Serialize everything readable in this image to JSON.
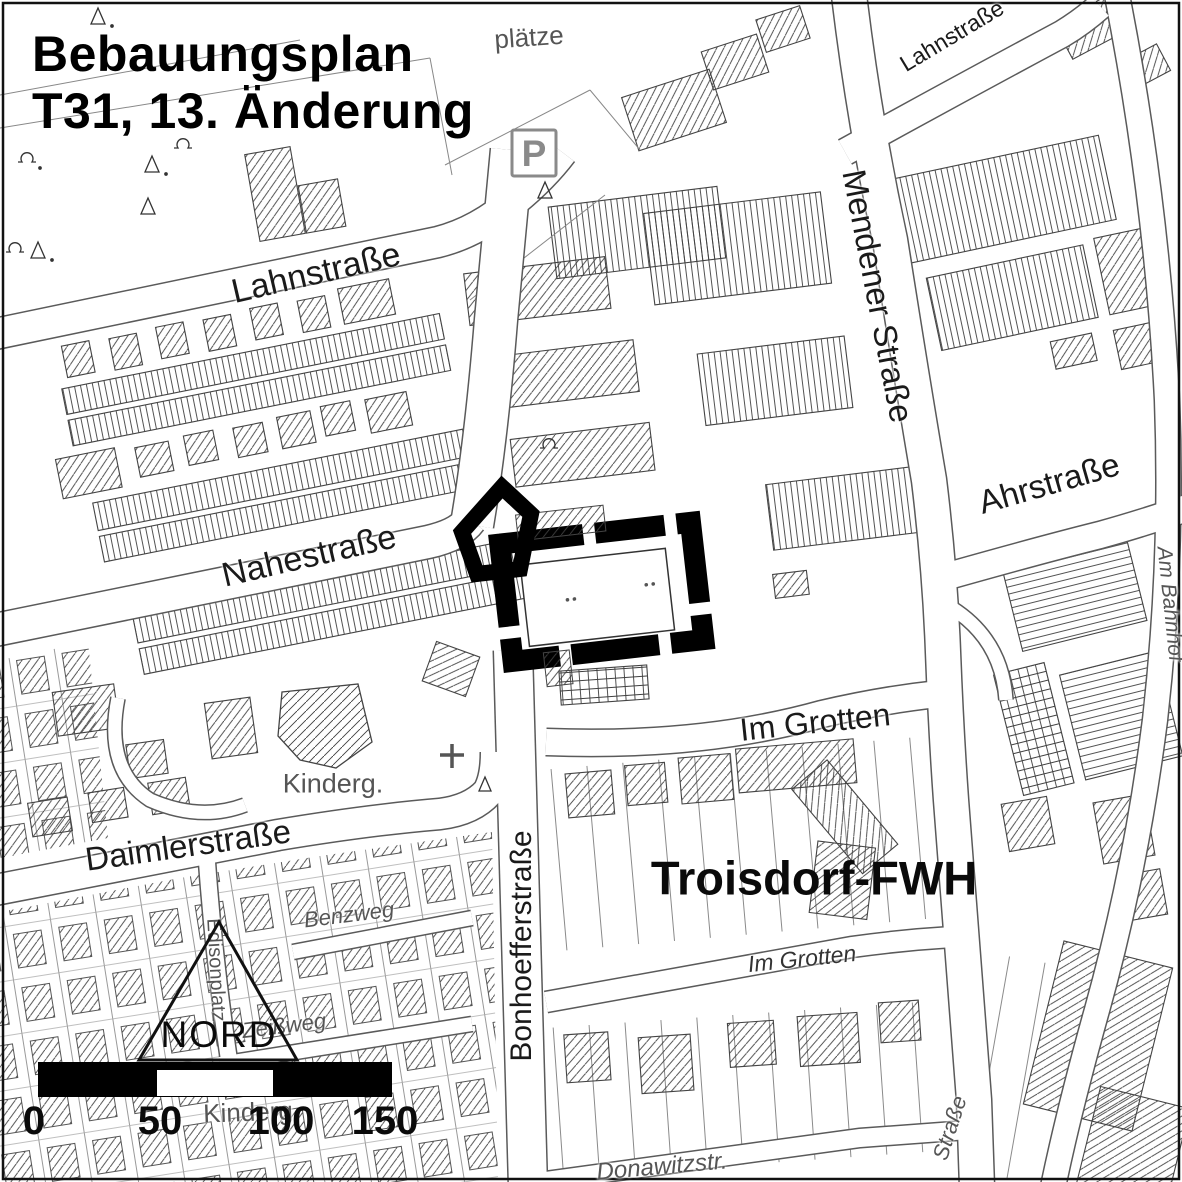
{
  "map": {
    "title": {
      "line1": "Bebauungsplan",
      "line2": "T31, 13. Änderung"
    },
    "region_label": "Troisdorf-FWH",
    "parking_symbol": "P",
    "north_label": "NORD",
    "scale_bar": {
      "ticks": [
        "0",
        "50",
        "100",
        "150"
      ]
    },
    "colors": {
      "ink": "#1a1a1a",
      "muted": "#555555",
      "hatch": "#3f3f3f",
      "street_edge": "#5a5a5a",
      "plan_boundary": "#000000"
    },
    "labels": [
      {
        "name": "street-label-lahnstrasse-top",
        "text": "Lahnstraße",
        "x": 952,
        "y": 36,
        "rot": -31,
        "size": 23,
        "cls": ""
      },
      {
        "name": "street-label-lahnstrasse",
        "text": "Lahnstraße",
        "x": 316,
        "y": 273,
        "rot": -13,
        "size": 34,
        "cls": ""
      },
      {
        "name": "street-label-nahestrasse",
        "text": "Nahestraße",
        "x": 309,
        "y": 556,
        "rot": -13,
        "size": 34,
        "cls": ""
      },
      {
        "name": "street-label-mendener-strasse",
        "text": "Mendener Straße",
        "x": 878,
        "y": 296,
        "rot": 79,
        "size": 33,
        "cls": ""
      },
      {
        "name": "street-label-ahrstrasse",
        "text": "Ahrstraße",
        "x": 1049,
        "y": 483,
        "rot": -16,
        "size": 33,
        "cls": ""
      },
      {
        "name": "street-label-im-grotten",
        "text": "Im Grotten",
        "x": 815,
        "y": 722,
        "rot": -6,
        "size": 32,
        "cls": ""
      },
      {
        "name": "street-label-daimlerstrasse",
        "text": "Daimlerstraße",
        "x": 188,
        "y": 845,
        "rot": -8,
        "size": 33,
        "cls": ""
      },
      {
        "name": "street-label-bonhoefferstrasse",
        "text": "Bonhoefferstraße",
        "x": 522,
        "y": 946,
        "rot": -90,
        "size": 30,
        "cls": ""
      },
      {
        "name": "street-label-benzweg",
        "text": "Benzweg",
        "x": 349,
        "y": 915,
        "rot": -7,
        "size": 22,
        "cls": "italic muted"
      },
      {
        "name": "street-label-edisonplatz",
        "text": "Edisonplatz",
        "x": 216,
        "y": 970,
        "rot": 87,
        "size": 20,
        "cls": "muted"
      },
      {
        "name": "street-label-zeissweg",
        "text": "Zeißweg",
        "x": 284,
        "y": 1026,
        "rot": -7,
        "size": 22,
        "cls": "italic muted"
      },
      {
        "name": "poi-label-kindergarten",
        "text": "Kinderg.",
        "x": 333,
        "y": 784,
        "rot": 0,
        "size": 27,
        "cls": "muted"
      },
      {
        "name": "poi-label-kindergarten-south",
        "text": "Kinderg",
        "x": 248,
        "y": 1112,
        "rot": -2,
        "size": 26,
        "cls": "muted under"
      },
      {
        "name": "street-label-donawitzstrasse",
        "text": "Donawitzstr.",
        "x": 662,
        "y": 1167,
        "rot": -5,
        "size": 24,
        "cls": "italic muted"
      },
      {
        "name": "street-label-am-bahnhof",
        "text": "Am Bahnhof",
        "x": 1170,
        "y": 604,
        "rot": 84,
        "size": 21,
        "cls": "italic muted"
      },
      {
        "name": "street-label-strasse-fragment",
        "text": "Straße",
        "x": 950,
        "y": 1128,
        "rot": -72,
        "size": 22,
        "cls": "italic muted"
      },
      {
        "name": "street-label-im-grotten-south",
        "text": "Im Grotten",
        "x": 802,
        "y": 959,
        "rot": -6,
        "size": 23,
        "cls": "italic dark"
      },
      {
        "name": "poi-label-plaetze",
        "text": "plätze",
        "x": 529,
        "y": 37,
        "rot": -4,
        "size": 26,
        "cls": "muted"
      }
    ]
  }
}
